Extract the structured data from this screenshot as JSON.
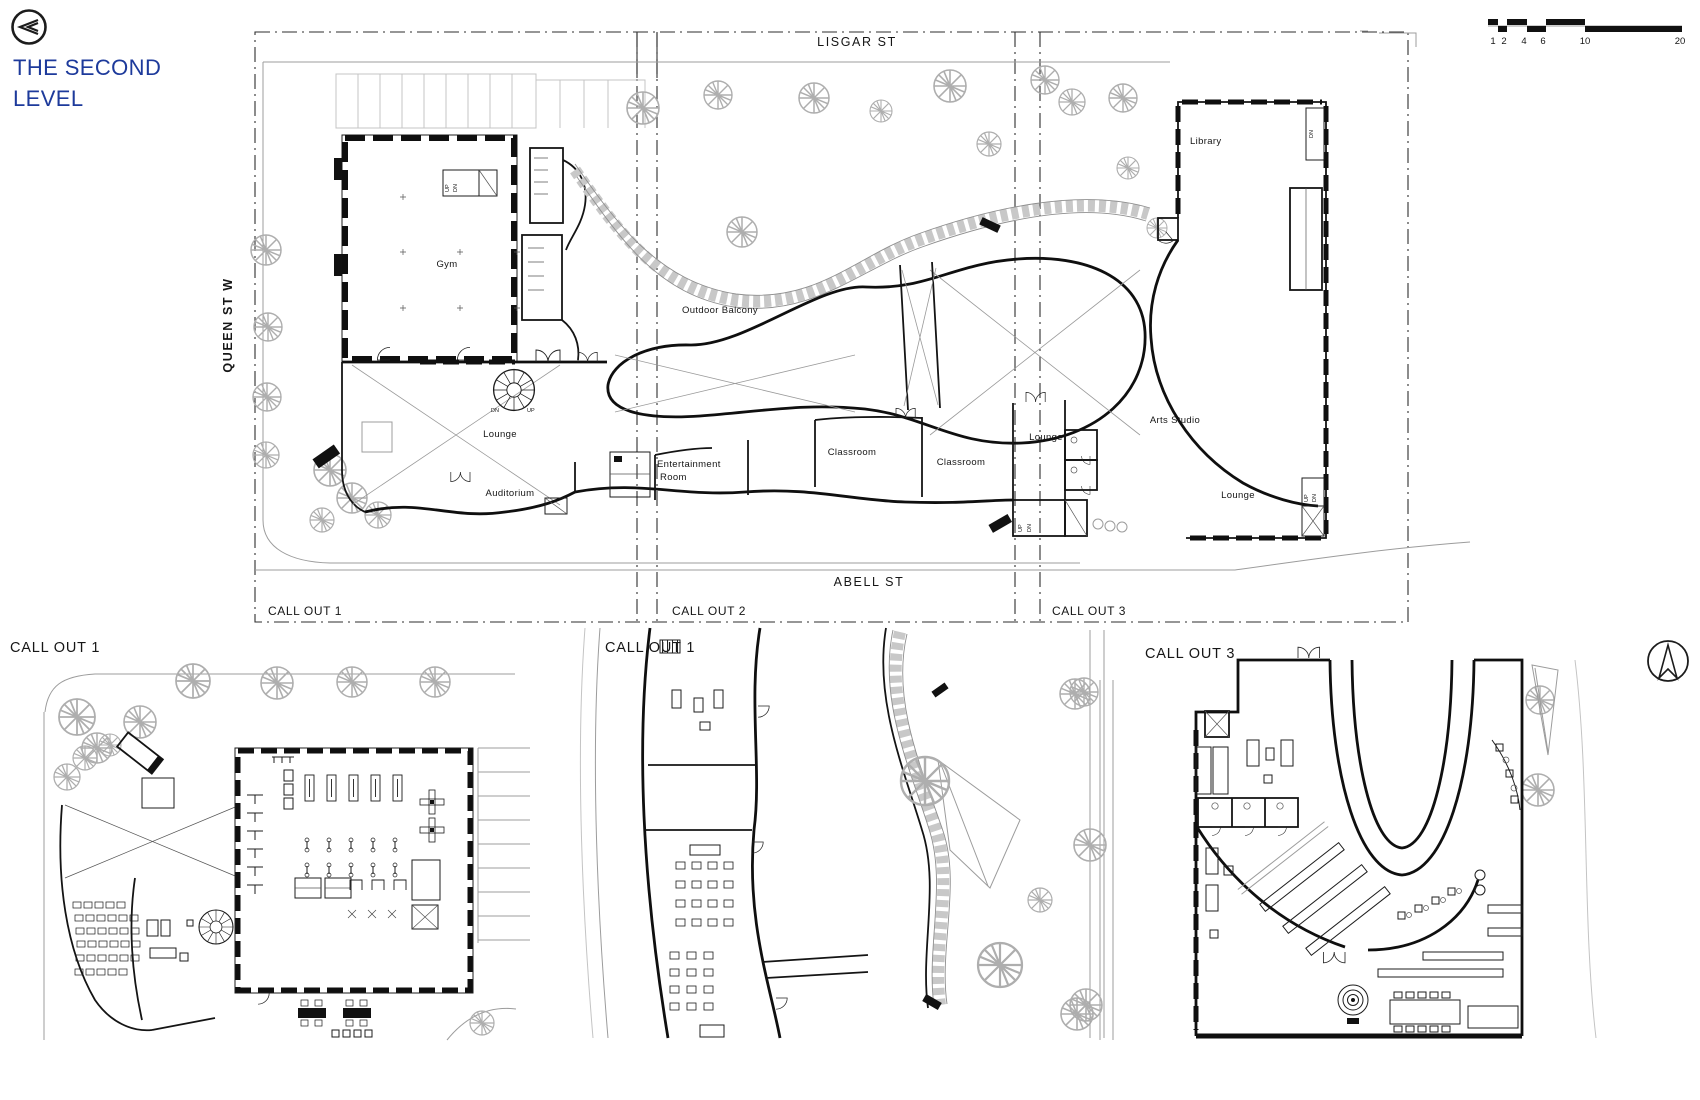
{
  "app": {
    "title_line1": "THE SECOND",
    "title_line2": "LEVEL",
    "title_color": "#1d3a9b",
    "icons": {
      "back": "double-chevron-left-in-circle",
      "north": "north-arrow-in-circle"
    }
  },
  "scale_bar": {
    "ticks": [
      "1",
      "2",
      "4",
      "6",
      "10",
      "20"
    ]
  },
  "main_plan": {
    "streets": {
      "top": "LISGAR ST",
      "left": "QUEEN ST W",
      "bottom": "ABELL ST"
    },
    "rooms": {
      "gym": "Gym",
      "library": "Library",
      "outdoor_balcony": "Outdoor Balcony",
      "lounge_left": "Lounge",
      "auditorium": "Auditorium",
      "entertainment_line1": "Entertainment",
      "entertainment_line2": "Room",
      "classroom_1": "Classroom",
      "classroom_2": "Classroom",
      "lounge_mid": "Lounge",
      "arts_studio": "Arts Studio",
      "lounge_right": "Lounge"
    },
    "stair_labels": {
      "up": "UP",
      "dn": "DN"
    },
    "callout_labels": [
      "CALL OUT 1",
      "CALL OUT 2",
      "CALL OUT 3"
    ]
  },
  "details": {
    "left_title": "CALL OUT 1",
    "middle_title": "CALL OUT 1",
    "right_title": "CALL OUT 3"
  }
}
